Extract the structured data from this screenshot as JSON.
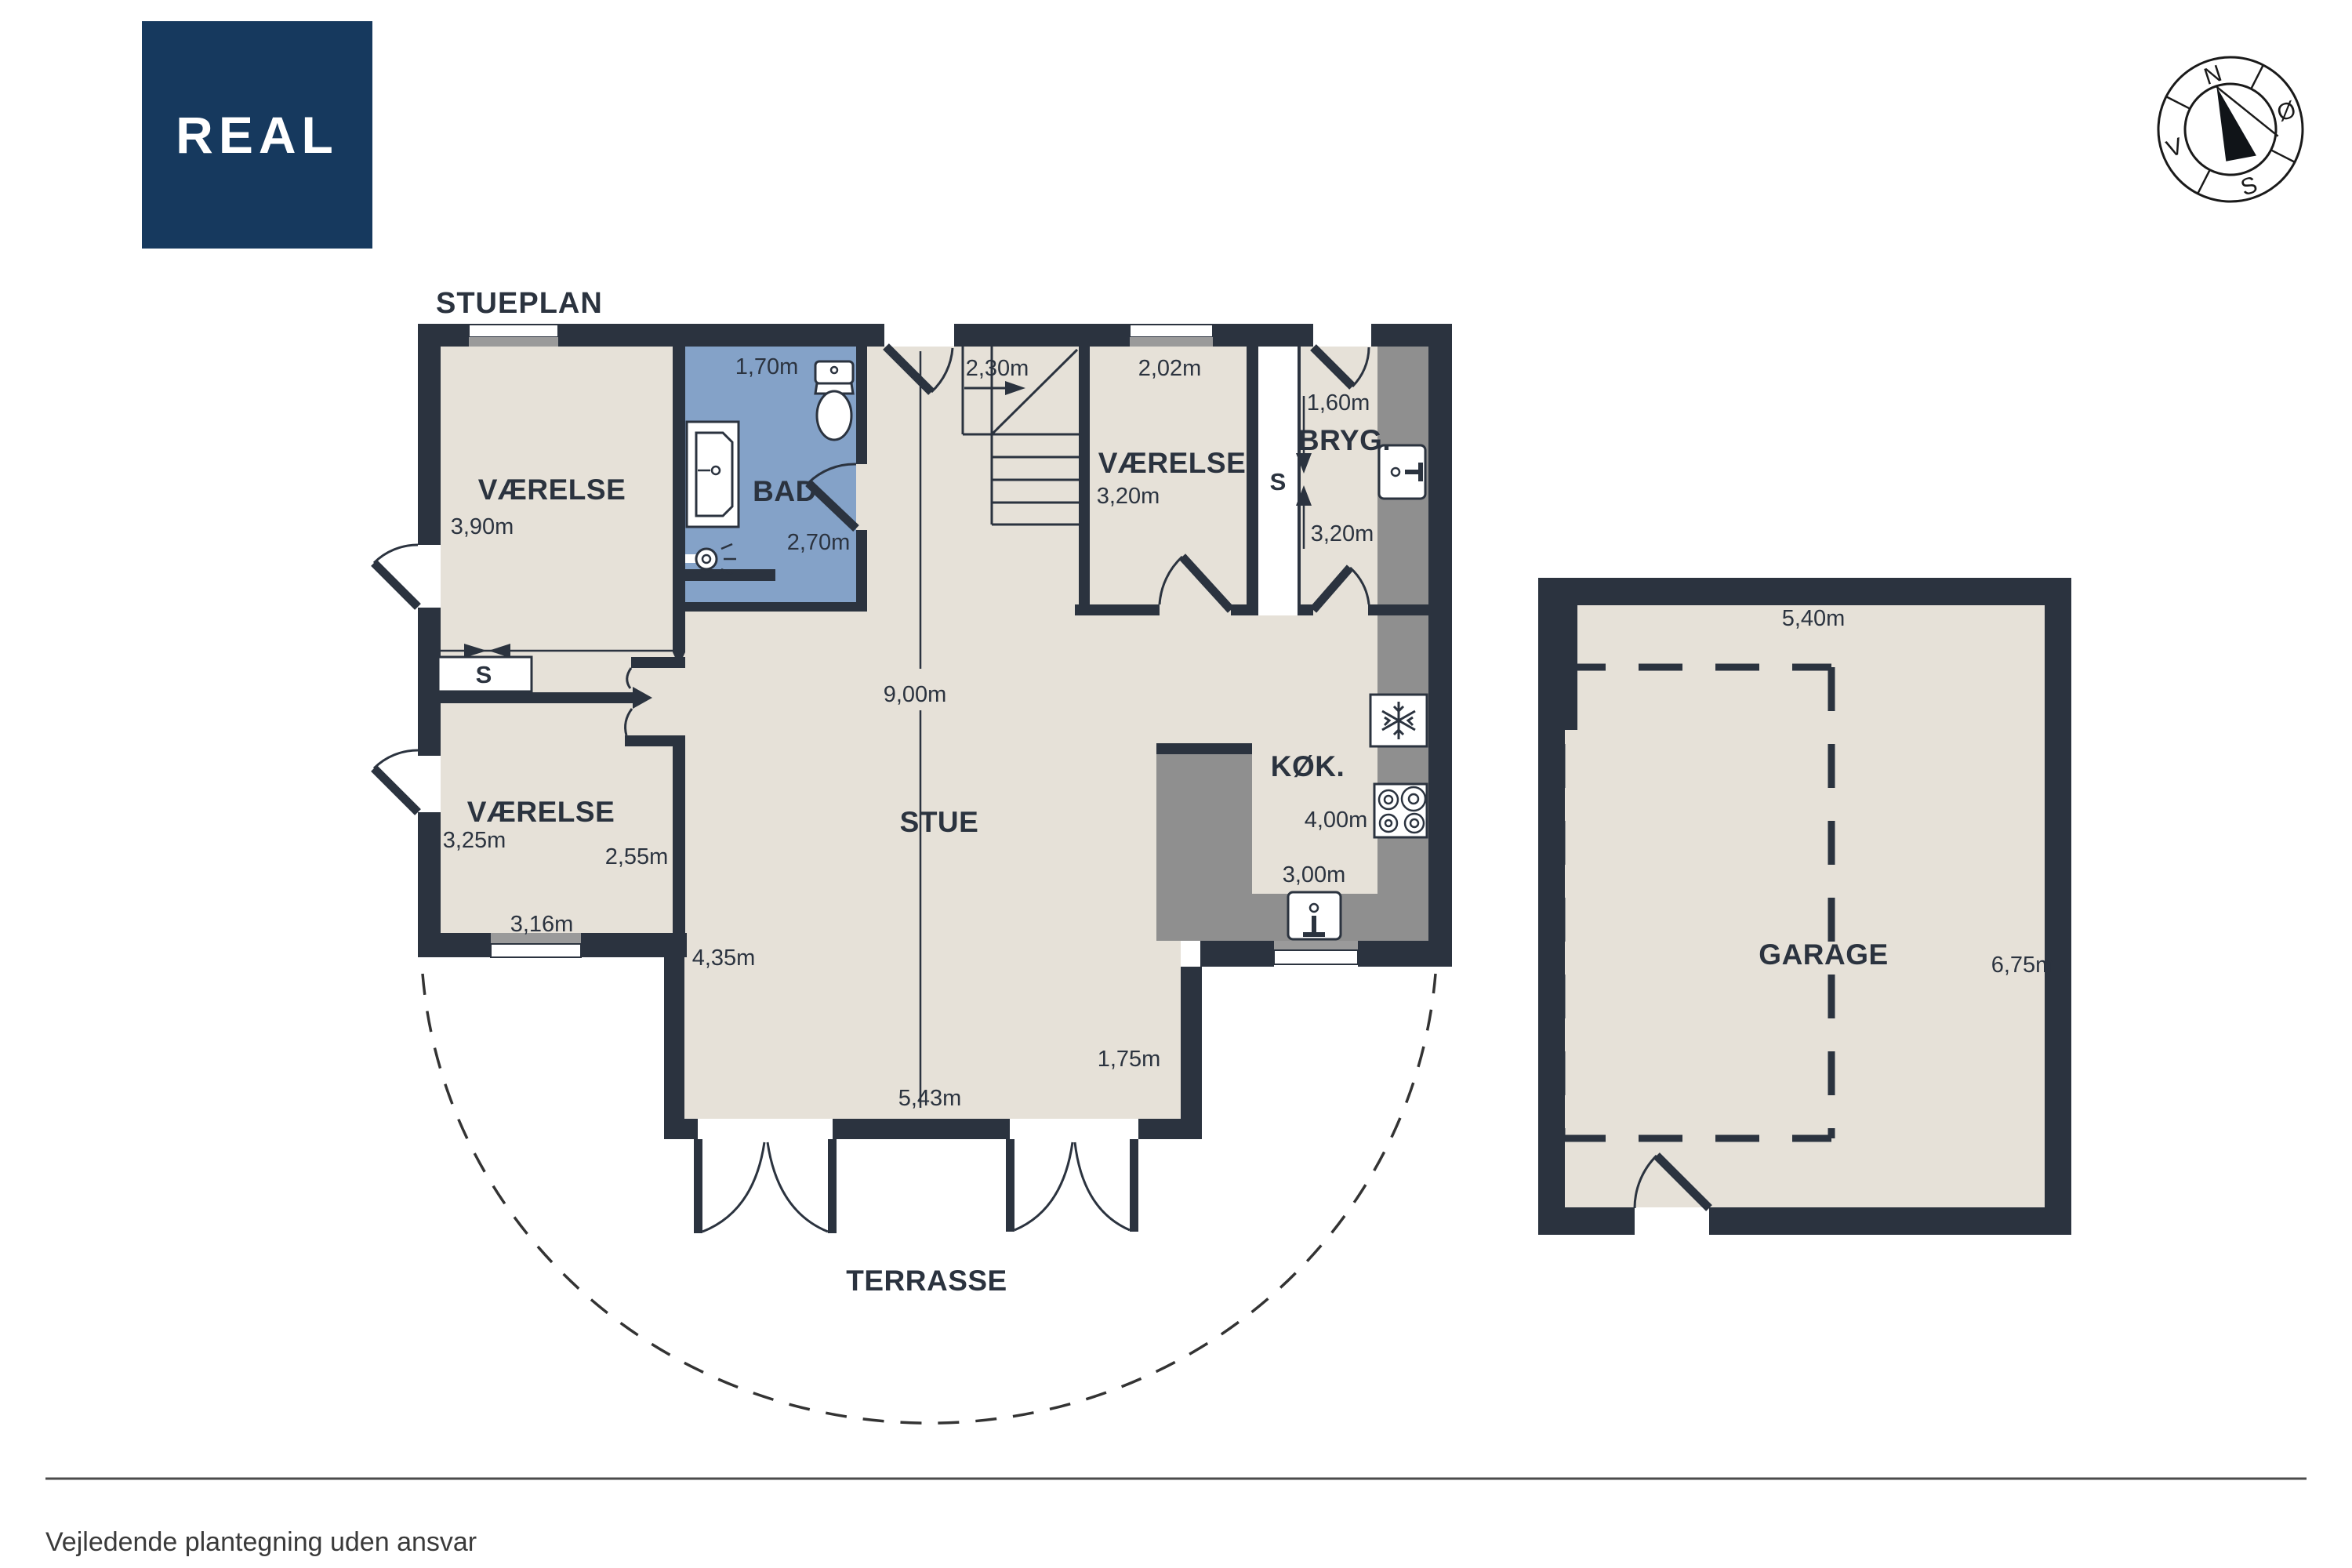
{
  "logo": {
    "text": "REAL",
    "bg_color": "#16395e"
  },
  "title": "STUEPLAN",
  "compass": {
    "north": "N",
    "east": "Ø",
    "south": "S",
    "west": "V"
  },
  "colors": {
    "wall": "#2b333f",
    "floor": "#e6e1d8",
    "bathroom": "#84a2c8",
    "counter_gray": "#8f8f8f",
    "logo_navy": "#16395e"
  },
  "labels": {
    "vaerelse1": "VÆRELSE",
    "bad": "BAD",
    "vaerelse2": "VÆRELSE",
    "bryg": "BRYG.",
    "koek": "KØK.",
    "stue": "STUE",
    "vaerelse3": "VÆRELSE",
    "garage": "GARAGE",
    "terrasse": "TERRASSE",
    "closet1": "S",
    "closet2": "S"
  },
  "dimensions": {
    "d170": "1,70m",
    "d390": "3,90m",
    "d270": "2,70m",
    "d230": "2,30m",
    "d202": "2,02m",
    "d320a": "3,20m",
    "d160": "1,60m",
    "d320b": "3,20m",
    "d900": "9,00m",
    "d400": "4,00m",
    "d300": "3,00m",
    "d325": "3,25m",
    "d255": "2,55m",
    "d316": "3,16m",
    "d435": "4,35m",
    "d543": "5,43m",
    "d175": "1,75m",
    "d540": "5,40m",
    "d675": "6,75m"
  },
  "footer": {
    "disclaimer": "Vejledende plantegning uden ansvar"
  }
}
